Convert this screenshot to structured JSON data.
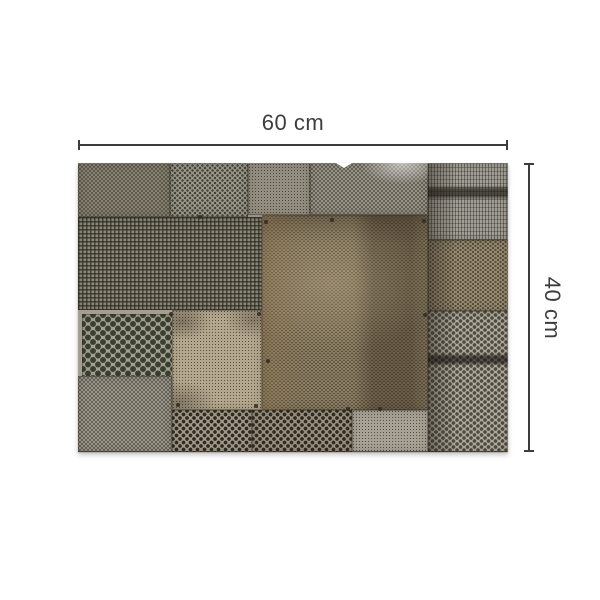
{
  "figure": {
    "description": "Patchwork collage of weathered perforated metal sheets",
    "width_label": "60 cm",
    "height_label": "40 cm"
  },
  "style": {
    "background_color": "#ffffff",
    "dimension_line_color": "#3c3c3c",
    "label_color": "#3d3d3d",
    "metal_palette": [
      "#8a8474",
      "#9e9a8e",
      "#948e80",
      "#8b8878",
      "#8f8165",
      "#b3a78d",
      "#a5a093",
      "#b0aa9d",
      "#9a917d",
      "#968a70"
    ]
  }
}
